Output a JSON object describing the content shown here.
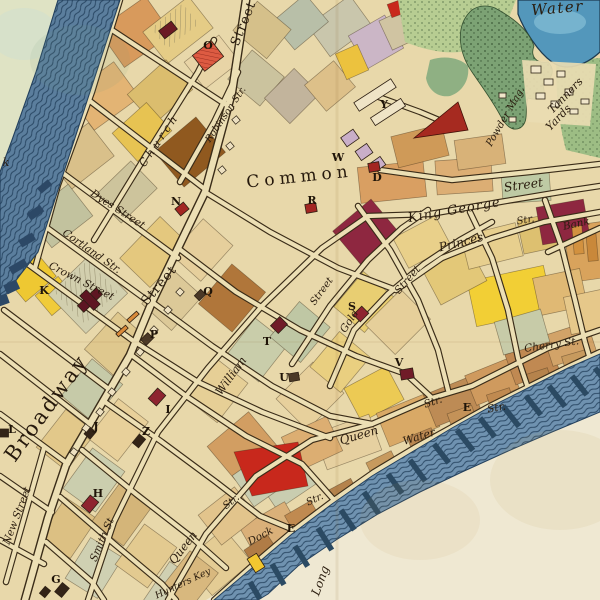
{
  "streets": {
    "broadway": "Broadway",
    "street_upper": "Street",
    "street_mid": "Street",
    "church": "Church",
    "robinson": "Robinson Str.",
    "dyes": "Dyes Street",
    "cortland": "Cortland Str.",
    "crown": "Crown Street",
    "new_street": "New Street",
    "smith": "Smith St",
    "william": "William",
    "street_near_s": "Street",
    "gold": "Gold",
    "gold_street": "Street",
    "king_george": "King George",
    "king_george_street": "Street",
    "str_block": "Str.",
    "bank": "Bank",
    "princes": "Princes",
    "queen_upper": "Queen",
    "queen_upper_str": "Str.",
    "water_street": "Water",
    "e_street_str": "Str.",
    "cherry": "Cherry St.",
    "dock": "Dock",
    "dock_str": "Str.",
    "queen_lower": "Queen",
    "queen_lower_str": "Str.",
    "hunters_key": "Hunters Key",
    "partial_k": "k"
  },
  "places": {
    "common": "Common",
    "fresh_water": "Water",
    "powder_mag": "Powder Mag.",
    "tanners_line1": "Tanners",
    "tanners_line2": "Yards",
    "long_island": "Long"
  },
  "markers": {
    "d": "D",
    "e_shore": "E",
    "e_dock": "E",
    "g": "G",
    "h": "H",
    "i": "I",
    "j": "J",
    "k": "K",
    "l": "L",
    "n": "N",
    "o": "O",
    "p": "P",
    "q": "Q",
    "r": "R",
    "s": "S",
    "t": "T",
    "u": "U",
    "v": "V",
    "w": "W",
    "y": "Y",
    "z": "Z"
  },
  "colors": {
    "paper": "#e8d8aa",
    "street_fill": "#ecdfb4",
    "ink": "#3a2c18",
    "river_blue": "#5b7e9d",
    "east_river": "#6f92b0",
    "pond_blue": "#5397bb",
    "marsh_green": "#7ca274",
    "field_green": "#b7cd92",
    "red_block": "#c8281c",
    "maroon_block": "#8e2740",
    "yellow_block": "#f2cf35",
    "brown_block": "#90591f",
    "lilac_building": "#c9aec8",
    "text": "#2a1c0e"
  }
}
